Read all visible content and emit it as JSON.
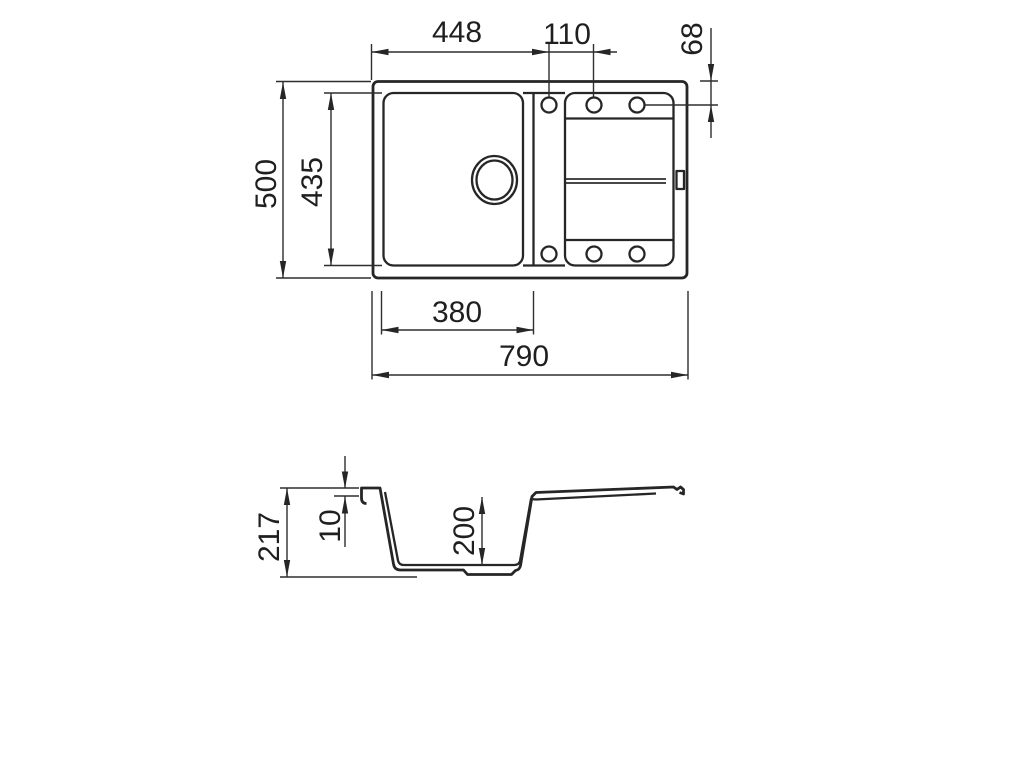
{
  "colors": {
    "background": "#ffffff",
    "line": "#262626",
    "text": "#1f1f1f"
  },
  "top_view": {
    "dim_left_edge_to_first_hole": "448",
    "dim_hole_spacing": "110",
    "dim_hole_offset_from_top_edge": "68",
    "dim_overall_depth": "500",
    "dim_basin_inner_depth": "435",
    "dim_basin_inner_width": "380",
    "dim_overall_width": "790"
  },
  "section_view": {
    "dim_overall_height": "217",
    "dim_rim_thickness": "10",
    "dim_bowl_depth": "200"
  }
}
